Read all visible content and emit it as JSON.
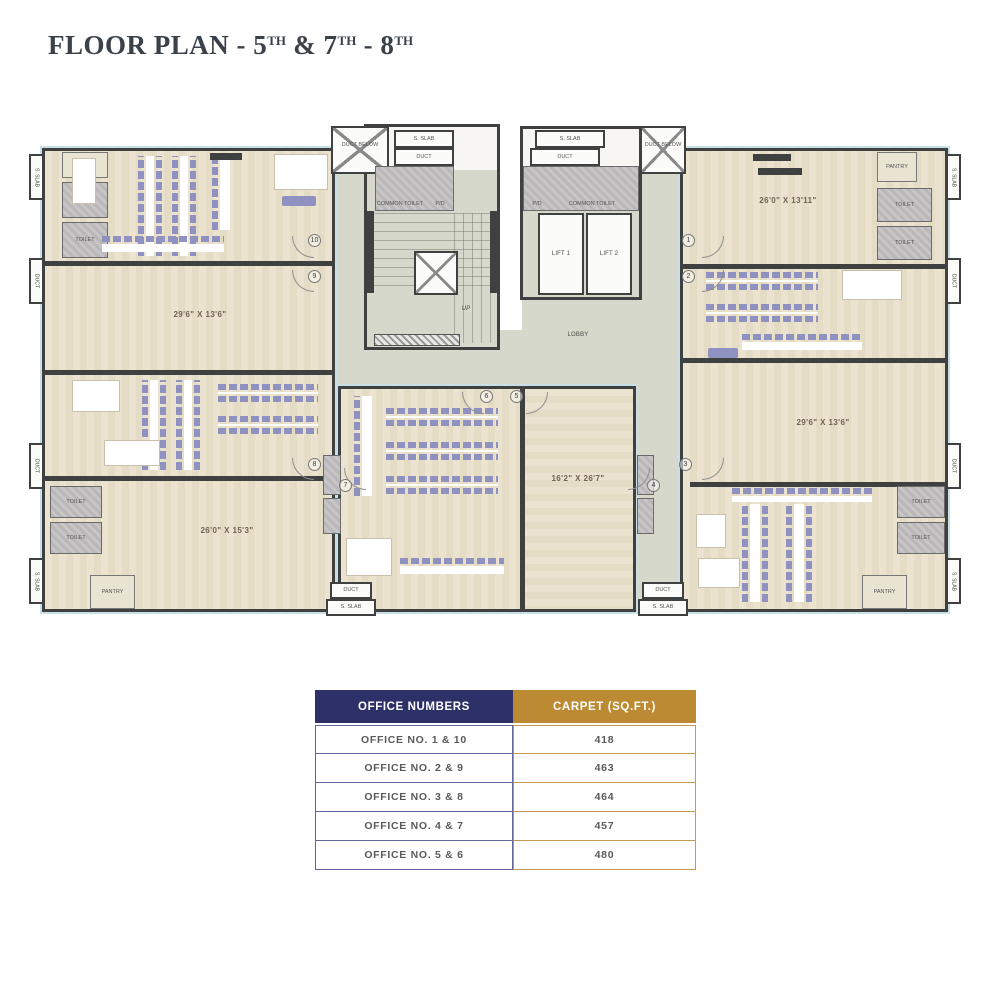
{
  "title": {
    "part1": "FLOOR PLAN - 5",
    "part2": " & 7",
    "part3": " - 8",
    "sup": "TH"
  },
  "plan": {
    "dims": {
      "room_left_mid": "29'6\" X 13'6\"",
      "room_left_bottom": "26'0\" X 15'3\"",
      "room_center": "16'2\" X 26'7\"",
      "room_right_top": "26'0\" X 13'11\"",
      "room_right_mid": "29'6\" X 13'6\""
    },
    "labels": {
      "lift1": "LIFT 1",
      "lift2": "LIFT 2",
      "lobby": "LOBBY",
      "up": "UP",
      "duct_below": "DUCT BELOW",
      "s_slab": "S. SLAB",
      "duct": "DUCT",
      "common_toilet": "COMMON TOILET",
      "pd": "P/D",
      "toilet": "TOILET",
      "pantry": "PANTRY"
    },
    "door_numbers": [
      "1",
      "2",
      "3",
      "4",
      "5",
      "6",
      "7",
      "8",
      "9",
      "10"
    ]
  },
  "table": {
    "headers": [
      "OFFICE NUMBERS",
      "CARPET (SQ.FT.)"
    ],
    "rows": [
      {
        "office": "OFFICE NO. 1 & 10",
        "carpet": "418"
      },
      {
        "office": "OFFICE NO. 2 & 9",
        "carpet": "463"
      },
      {
        "office": "OFFICE NO. 3 & 8",
        "carpet": "464"
      },
      {
        "office": "OFFICE NO. 4 & 7",
        "carpet": "457"
      },
      {
        "office": "OFFICE NO. 5 & 6",
        "carpet": "480"
      }
    ],
    "colors": {
      "header_left_bg": "#2e3168",
      "header_right_bg": "#bc8a33",
      "accent_wall": "#3f4040"
    }
  }
}
